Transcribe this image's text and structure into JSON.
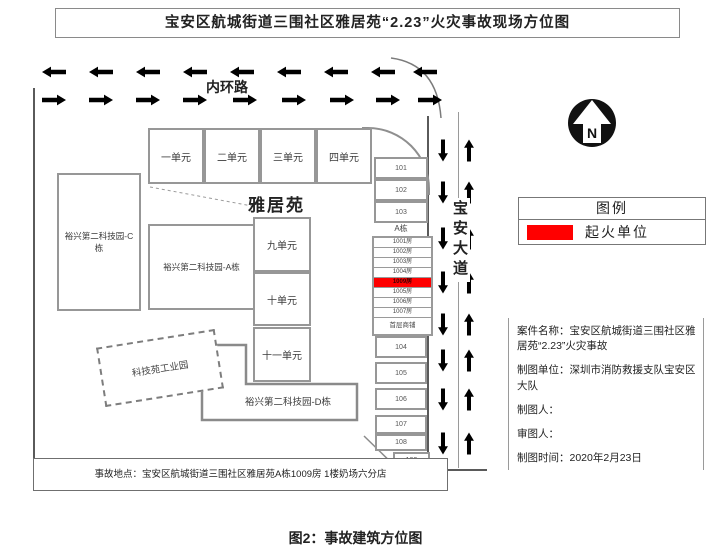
{
  "title": "宝安区航城街道三围社区雅居苑“2.23”火灾事故现场方位图",
  "caption": "图2：事故建筑方位图",
  "roads": {
    "top": "内环路",
    "right": "宝安大道"
  },
  "complex": "雅居苑",
  "buildings": {
    "units_top": [
      "一单元",
      "二单元",
      "三单元",
      "四单元"
    ],
    "units_mid": [
      "九单元",
      "十单元",
      "十一单元"
    ],
    "c": "裕兴第二科技园-C栋",
    "a": "裕兴第二科技园-A栋",
    "d": "裕兴第二科技园-D栋",
    "industrial": "科技苑工业园",
    "block_a": "A栋",
    "shops_top": [
      "101",
      "102",
      "103"
    ],
    "shop_rows": [
      "1001房",
      "1002房",
      "1003房",
      "1004房",
      "1009房",
      "1005房",
      "1006房",
      "1007房"
    ],
    "shop_rows_bottom": "首层商铺",
    "shops_bottom": [
      "104",
      "105",
      "106",
      "107",
      "108",
      "109"
    ]
  },
  "legend": {
    "title": "图例",
    "fire_label": "起火单位",
    "fire_color": "#ff0000"
  },
  "compass_label": "N",
  "info": {
    "case": "案件名称：宝安区航城街道三围社区雅居苑“2.23”火灾事故",
    "unit": "制图单位：深圳市消防救援支队宝安区大队",
    "drafter": "制图人：",
    "reviewer": "审图人：",
    "date": "制图时间：2020年2月23日"
  },
  "location_note": "事故地点：宝安区航城街道三围社区雅居苑A栋1009房 1楼奶场六分店"
}
